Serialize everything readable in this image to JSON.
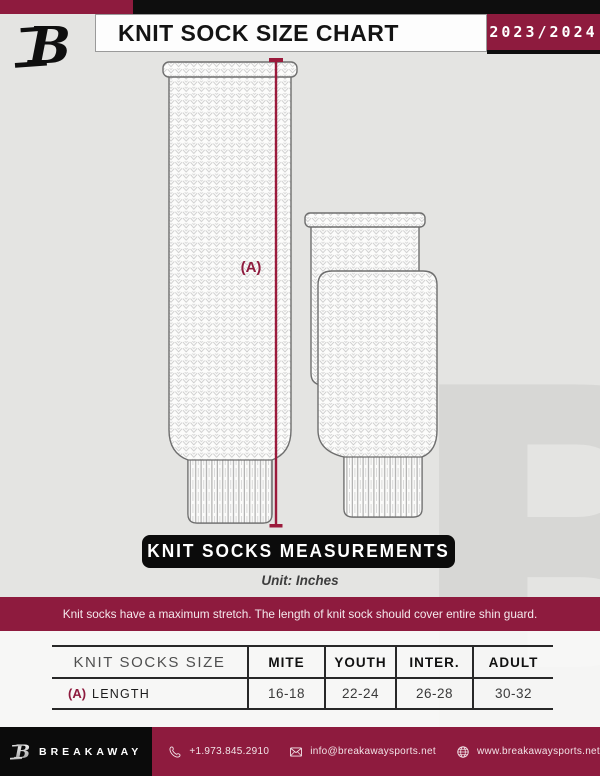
{
  "header": {
    "title": "KNIT SOCK SIZE CHART",
    "season": "2023/2024",
    "logo_letter": "B"
  },
  "diagram": {
    "dimension_label": "(A)",
    "measurements_banner": "KNIT SOCKS MEASUREMENTS",
    "unit_note": "Unit: Inches",
    "notice": "Knit socks have a maximum stretch. The length of knit sock should cover entire shin guard."
  },
  "size_table": {
    "columns": [
      "KNIT SOCKS SIZE",
      "MITE",
      "YOUTH",
      "INTER.",
      "ADULT"
    ],
    "rows": [
      {
        "prefix": "(A)",
        "label": "LENGTH",
        "values": [
          "16-18",
          "22-24",
          "26-28",
          "30-32"
        ]
      }
    ]
  },
  "footer": {
    "brand": "BREAKAWAY",
    "brand_letter": "B",
    "phone": "+1.973.845.2910",
    "email": "info@breakawaysports.net",
    "website": "www.breakawaysports.net"
  },
  "background": {
    "watermark_letter": "B"
  },
  "colors": {
    "maroon": "#8e1b3e",
    "black": "#0e0e0e",
    "background_gray": "#e4e4e2",
    "measure_line": "#9b1b3c"
  }
}
